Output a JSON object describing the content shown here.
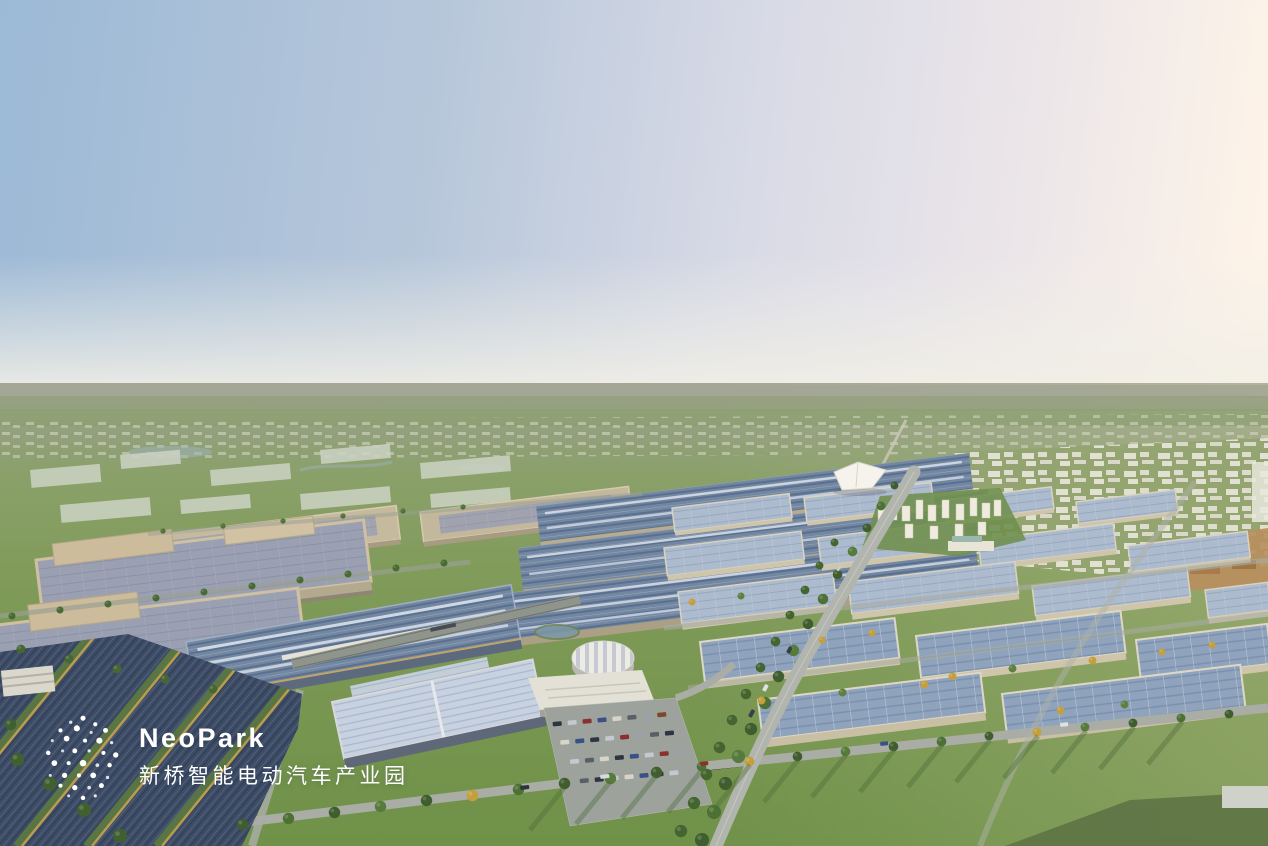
{
  "meta": {
    "image_type": "architectural aerial rendering",
    "time_of_day": "dusk"
  },
  "logo": {
    "brand": "NeoPark",
    "brand_cn": "新桥智能电动汽车产业园",
    "mark": "dot-constellation-logo",
    "text_color": "#ffffff"
  },
  "scene": {
    "description": "Dusk aerial rendering of the NeoPark smart electric-vehicle industrial park: solar-roof factories and warehouse grids separated by tree-lined boulevards, a round exhibition hall, parking lots, residential towers and a white event tent, with hazy green farmland and a distant white city at the horizon.",
    "palette": {
      "sky_blue": "#9cb9d6",
      "sky_pink": "#fdf3e8",
      "horizon_haze": "#ece9e0",
      "far_field": "#a8a794",
      "field_green": "#7f9a58",
      "lawn_green": "#6f9148",
      "tree_green": "#4a6a33",
      "tree_gold": "#c49f3e",
      "roof_steel_blue": "#7487a1",
      "roof_lavender": "#9aa0b2",
      "roof_light_blue": "#adbbce",
      "wall_tan": "#c6ba9e",
      "solar_panel_dark": "#3e4c65",
      "solar_trim_gold": "#c1a14f",
      "road_grey": "#b2b5ae",
      "city_white": "#e8e6db",
      "accent_orange": "#b98f5e",
      "water_blue": "#9db3b6"
    }
  }
}
